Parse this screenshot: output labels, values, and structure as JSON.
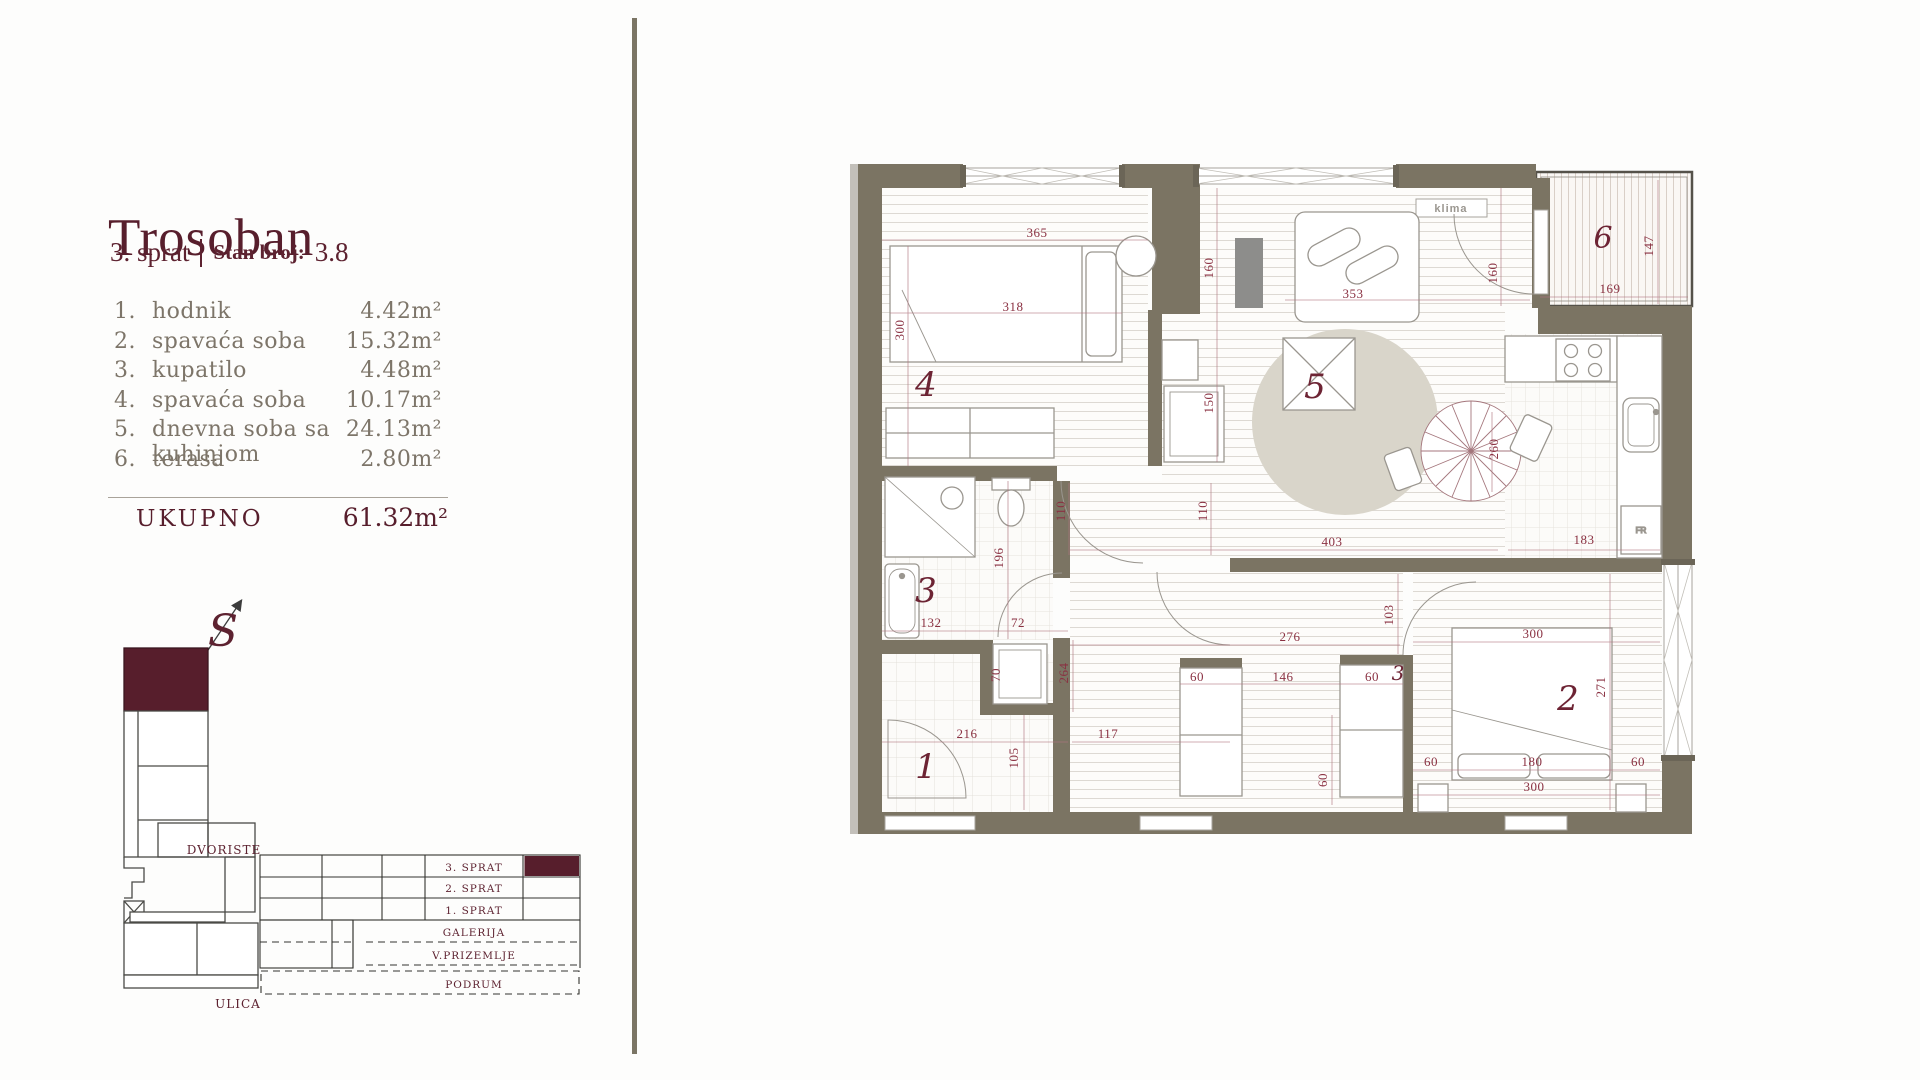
{
  "panel": {
    "title": "Trosoban",
    "floor_label": "3. sprat",
    "unit_label": "Stan broj:",
    "unit_number": "3.8",
    "rooms": [
      {
        "num": "1.",
        "name": "hodnik",
        "area": "4.42m²"
      },
      {
        "num": "2.",
        "name": "spavaća soba",
        "area": "15.32m²"
      },
      {
        "num": "3.",
        "name": "kupatilo",
        "area": "4.48m²"
      },
      {
        "num": "4.",
        "name": "spavaća soba",
        "area": "10.17m²"
      },
      {
        "num": "5.",
        "name": "dnevna soba sa kuhinjom",
        "area": "24.13m²"
      },
      {
        "num": "6.",
        "name": "terasa",
        "area": "2.80m²"
      }
    ],
    "total_label": "UKUPNO",
    "total_area": "61.32m²"
  },
  "compass": {
    "letter": "S"
  },
  "siteplan": {
    "yard_label": "DVORISTE",
    "street_label": "ULICA",
    "floors": {
      "f3": "3. SPRAT",
      "f2": "2. SPRAT",
      "f1": "1. SPRAT",
      "galerija": "GALERIJA",
      "vprizemlje": "V.PRIZEMLJE",
      "podrum": "PODRUM"
    }
  },
  "floorplan": {
    "klima_label": "klima",
    "fridge_label": "FR",
    "rooms": {
      "r1": "1",
      "r2": "2",
      "r3": "3",
      "r4": "4",
      "r5": "5",
      "r6": "6",
      "corridor_mark": "3"
    },
    "dims": {
      "d365": "365",
      "d318": "318",
      "d300_left": "300",
      "d160_hall": "160",
      "d150": "150",
      "d353": "353",
      "d160_terrace_door": "160",
      "d147": "147",
      "d169": "169",
      "d260": "260",
      "d403": "403",
      "d183": "183",
      "d110_a": "110",
      "d110_b": "110",
      "d196": "196",
      "d132": "132",
      "d72": "72",
      "d70": "70",
      "d264": "264",
      "d216": "216",
      "d105": "105",
      "d117": "117",
      "d276": "276",
      "d103": "103",
      "d300_bed_top": "300",
      "d60_closet_l": "60",
      "d146": "146",
      "d60_closet_r": "60",
      "d271": "271",
      "d60_rot": "60",
      "d60_nightstand_l": "60",
      "d180": "180",
      "d60_nightstand_r": "60",
      "d300_bed_bottom": "300"
    }
  },
  "colors": {
    "accent_maroon": "#571e2c",
    "dim_wine": "#8a3142",
    "wall_olive": "#7b7463",
    "list_gray": "#7d7569",
    "rug_beige": "#d9d5ca",
    "divider": "#7b7565"
  }
}
